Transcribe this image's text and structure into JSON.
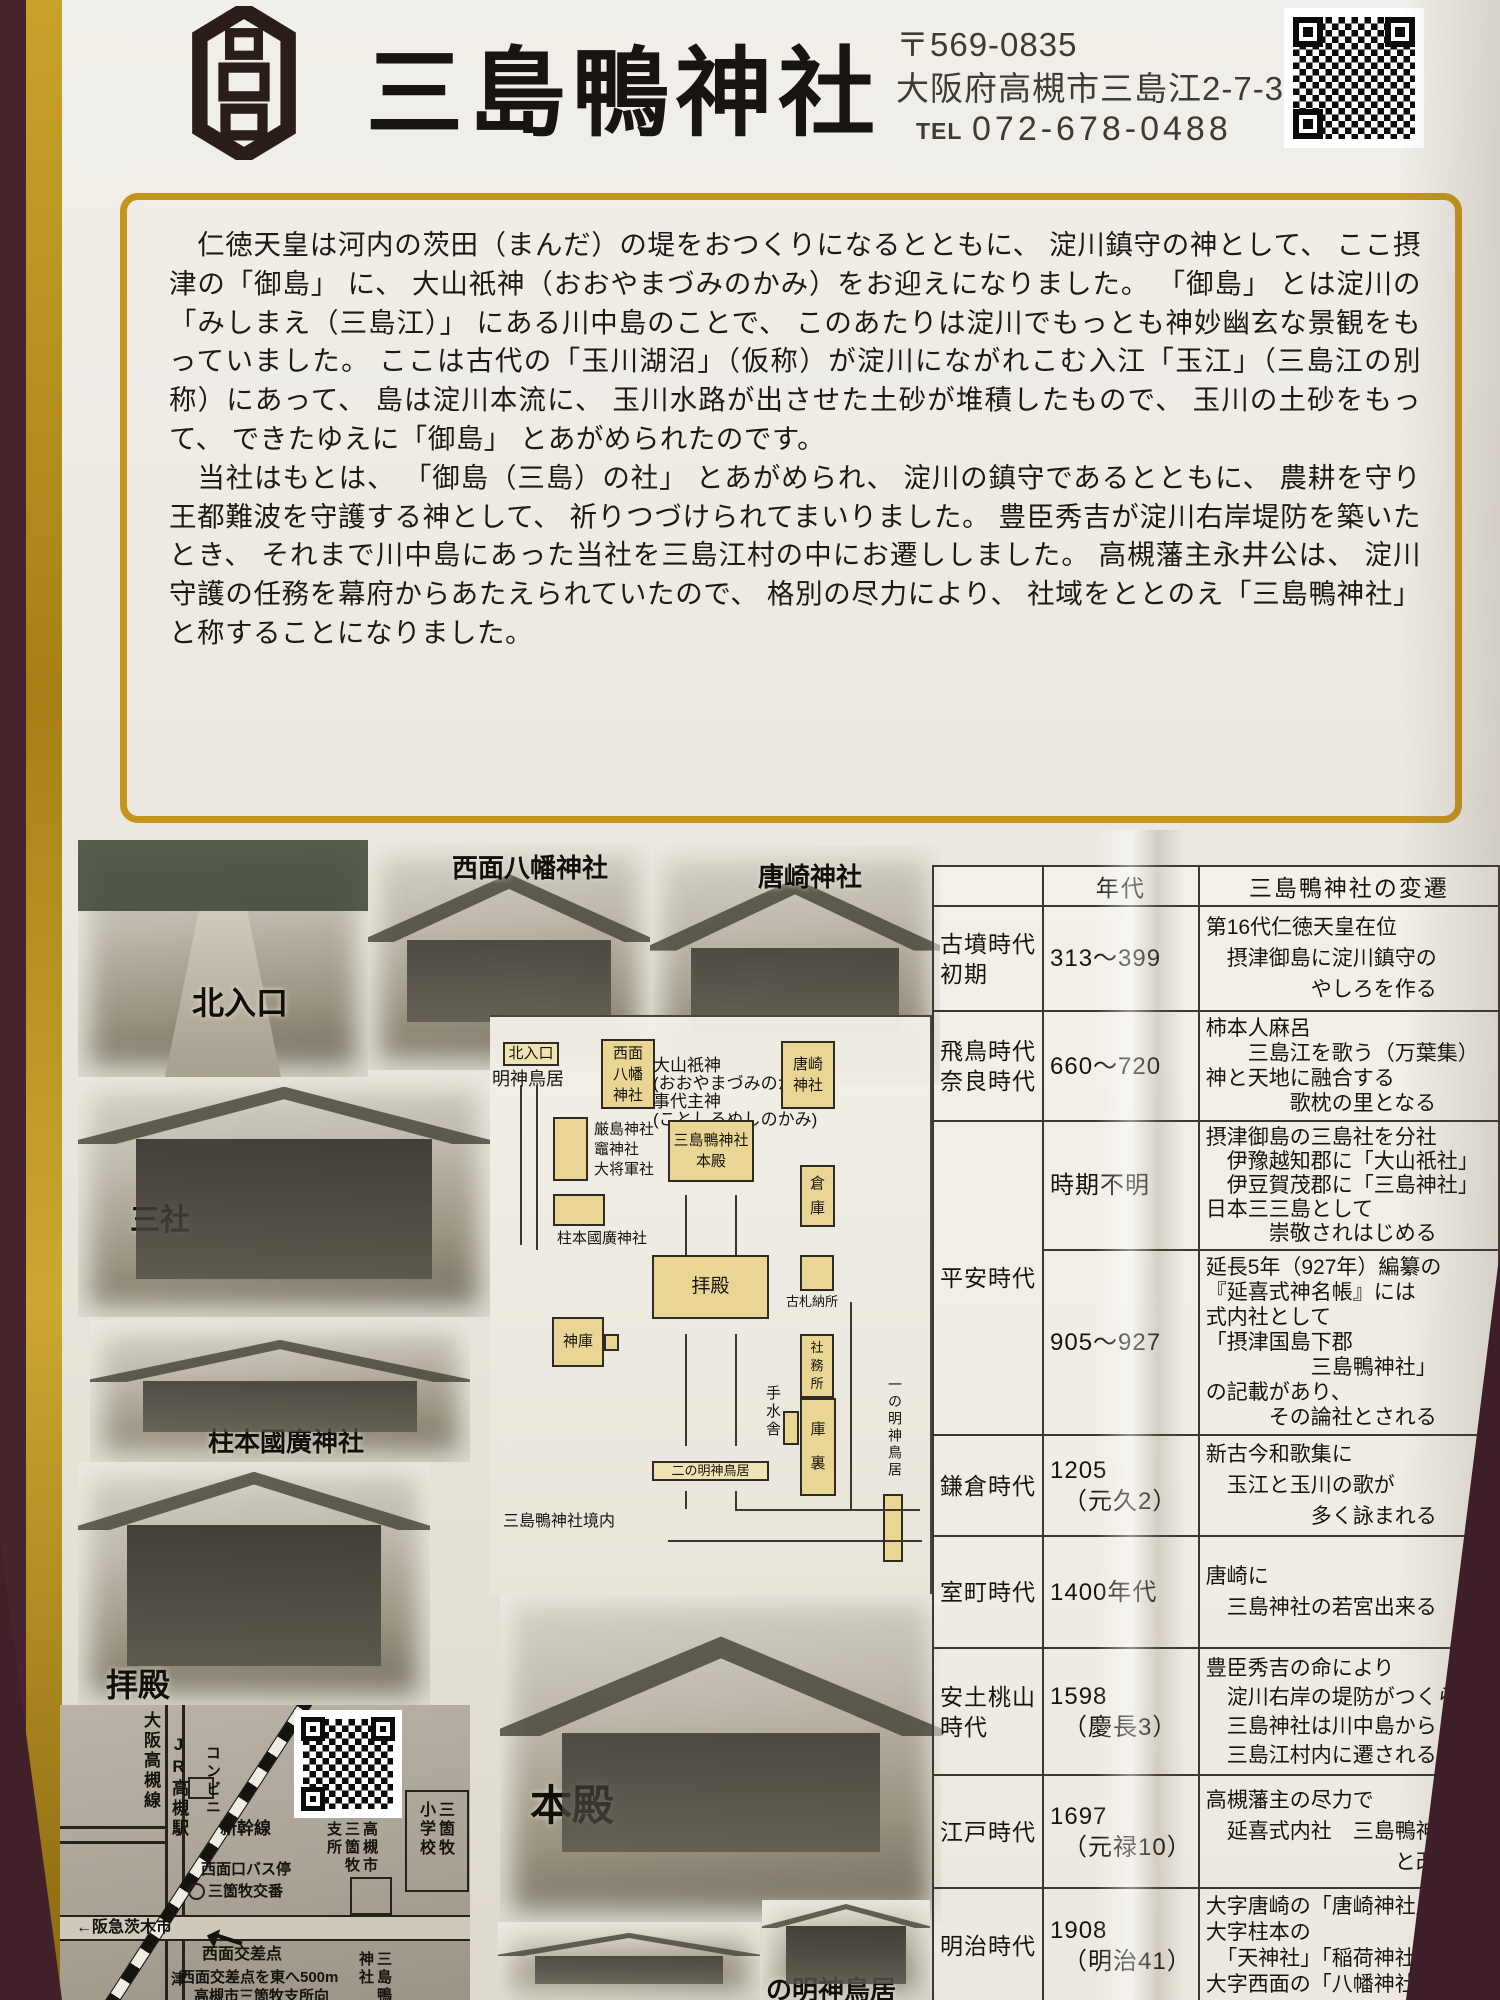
{
  "header": {
    "title": "三島鴨神社",
    "postal": "〒569-0835",
    "address": "大阪府高槻市三島江2-7-37",
    "tel_label": "TEL",
    "tel": "072-678-0488",
    "crest_name": "shrine-crest",
    "accent_gold": "#c3951c",
    "paper_color": "#ece9e2",
    "background_color": "#47242c"
  },
  "intro": {
    "paragraph1": "　仁徳天皇は河内の茨田（まんだ）の堤をおつくりになるとともに、 淀川鎮守の神として、 ここ摂津の「御島」 に、 大山祇神（おおやまづみのかみ）をお迎えになりました。 「御島」 とは淀川の「みしまえ（三島江）」 にある川中島のことで、 このあたりは淀川でもっとも神妙幽玄な景観をもっていました。 ここは古代の「玉川湖沼」（仮称）が淀川にながれこむ入江「玉江」（三島江の別称）にあって、 島は淀川本流に、 玉川水路が出させた土砂が堆積したもので、 玉川の土砂をもって、 できたゆえに「御島」 とあがめられたのです。",
    "paragraph2": "　当社はもとは、 「御島（三島）の社」 とあがめられ、 淀川の鎮守であるとともに、 農耕を守り王都難波を守護する神として、 祈りつづけられてまいりました。 豊臣秀吉が淀川右岸堤防を築いたとき、 それまで川中島にあった当社を三島江村の中にお遷ししました。 高槻藩主永井公は、 淀川守護の任務を幕府からあたえられていたので、 格別の尽力により、 社域をととのえ「三島鴨神社」 と称することになりました。"
  },
  "photos": [
    {
      "id": "kita",
      "caption": "北入口"
    },
    {
      "id": "seimen",
      "caption": "西面八幡神社"
    },
    {
      "id": "karasaki",
      "caption": "唐崎神社"
    },
    {
      "id": "sansha",
      "caption": "三社"
    },
    {
      "id": "hashiramoto",
      "caption": "柱本國廣神社"
    },
    {
      "id": "haiden",
      "caption": "拝殿"
    },
    {
      "id": "honden",
      "caption": "本殿"
    },
    {
      "id": "small-left",
      "caption": ""
    },
    {
      "id": "small-right",
      "caption": "の明神鳥居"
    }
  ],
  "diagram": {
    "items": [
      {
        "id": "kita-iriguchi-tag",
        "kind": "tag",
        "text": "北入口"
      },
      {
        "id": "myojin-torii-label",
        "kind": "label",
        "text": "明神鳥居"
      },
      {
        "id": "seimen-hachiman-box",
        "kind": "box",
        "text": "西面\n八幡\n神社"
      },
      {
        "id": "deities-label",
        "kind": "label",
        "text": "大山祇神\n(おおやまづみのかみ)\n事代主神\n(ことしろぬしのかみ)"
      },
      {
        "id": "karasaki-box",
        "kind": "box",
        "text": "唐崎\n神社"
      },
      {
        "id": "sansha-box",
        "kind": "box",
        "text": ""
      },
      {
        "id": "sansha-label",
        "kind": "label",
        "text": "厳島神社\n竈神社\n大将軍社"
      },
      {
        "id": "honden-box",
        "kind": "box",
        "text": "三島鴨神社\n本殿"
      },
      {
        "id": "soko-box",
        "kind": "box",
        "text": "倉\n庫"
      },
      {
        "id": "hashiramoto-box",
        "kind": "box",
        "text": ""
      },
      {
        "id": "hashiramoto-label",
        "kind": "label",
        "text": "柱本國廣神社"
      },
      {
        "id": "haiden-box",
        "kind": "box",
        "text": "拝殿"
      },
      {
        "id": "kosatsu-box",
        "kind": "box",
        "text": ""
      },
      {
        "id": "kosatsu-label",
        "kind": "label",
        "text": "古札納所"
      },
      {
        "id": "shinko-box",
        "kind": "box",
        "text": "神庫"
      },
      {
        "id": "shinko-tab",
        "kind": "box",
        "text": ""
      },
      {
        "id": "temizusha-label",
        "kind": "vlabel",
        "text": "手水舎"
      },
      {
        "id": "temizusha-box",
        "kind": "box",
        "text": ""
      },
      {
        "id": "shamusho-box",
        "kind": "box",
        "text": "社\n務\n所"
      },
      {
        "id": "kuri-box",
        "kind": "box",
        "text": "庫\n裏"
      },
      {
        "id": "ni-no-torii-tag",
        "kind": "tag",
        "text": "二の明神鳥居"
      },
      {
        "id": "ichi-no-torii-label",
        "kind": "vlabel",
        "text": "一の明神鳥居"
      },
      {
        "id": "ichi-no-torii-box",
        "kind": "box",
        "text": ""
      },
      {
        "id": "keidai-label",
        "kind": "label",
        "text": "三島鴨神社境内"
      }
    ]
  },
  "timeline": {
    "col_headers": [
      "",
      "年代",
      "三島鴨神社の変遷"
    ],
    "rows": [
      {
        "era": "古墳時代\n初期",
        "period": "313～399",
        "events": "第16代仁徳天皇在位\n　摂津御島に淀川鎮守の\n　　　　　やしろを作る"
      },
      {
        "era": "飛鳥時代\n奈良時代",
        "period": "660～720",
        "events": "柿本人麻呂\n　　三島江を歌う（万葉集）\n神と天地に融合する\n　　　　歌枕の里となる"
      },
      {
        "era": "平安時代",
        "era_rowspan": 2,
        "period": "時期不明",
        "events": "摂津御島の三島社を分社\n　伊豫越知郡に「大山祇社」\n　伊豆賀茂郡に「三島神社」\n日本三三島として\n　　　崇敬されはじめる"
      },
      {
        "era": null,
        "period": "905～927",
        "events": "延長5年（927年）編纂の\n『延喜式神名帳』には\n式内社として\n「摂津国島下郡\n　　　　　三島鴨神社」\nの記載があり、\n　　　その論社とされる"
      },
      {
        "era": "鎌倉時代",
        "period": "1205\n　（元久2）",
        "events": "新古今和歌集に\n　玉江と玉川の歌が\n　　　　　多く詠まれる"
      },
      {
        "era": "室町時代",
        "period": "1400年代",
        "events": "唐崎に\n　三島神社の若宮出来る"
      },
      {
        "era": "安土桃山\n時代",
        "period": "1598\n　（慶長3）",
        "events": "豊臣秀吉の命により\n　淀川右岸の堤防がつくられ\n　三島神社は川中島から\n　三島江村内に遷される"
      },
      {
        "era": "江戸時代",
        "period": "1697\n　（元禄10）",
        "events": "高槻藩主の尽力で\n　延喜式内社　三島鴨神社\n　　　　　　　　　と改称"
      },
      {
        "era": "明治時代",
        "period": "1908\n　（明治41）",
        "events": "大字唐崎の「唐崎神社」\n大字柱本の\n　「天神社」「稲荷神社」\n大字西面の「八幡神社」"
      }
    ]
  },
  "map": {
    "labels": [
      {
        "id": "osaka-takatsuki-line",
        "text": "大阪高槻線",
        "v": true
      },
      {
        "id": "jr-takatsuki-station",
        "text": "JR高槻駅",
        "v": true
      },
      {
        "id": "convenience-store",
        "text": "コンビニ",
        "v": true
      },
      {
        "id": "shinkansen",
        "text": "新幹線"
      },
      {
        "id": "seimen-bus-stop",
        "text": "西面口バス停"
      },
      {
        "id": "sankamaki-police-box",
        "text": "三箇牧交番"
      },
      {
        "id": "city-branch-office",
        "text": "高槻市\n三箇牧\n支所",
        "v": true
      },
      {
        "id": "sankamaki-elementary",
        "text": "三箇牧\n小学校",
        "v": true
      },
      {
        "id": "hankyu-ibaraki",
        "text": "←阪急茨木市"
      },
      {
        "id": "seimen-crossing",
        "text": "西面交差点"
      },
      {
        "id": "direction-1",
        "text": "西面交差点を東へ500m"
      },
      {
        "id": "direction-2",
        "text": "高槻市三箇牧支所向"
      },
      {
        "id": "mishima-kamo-jinja",
        "text": "三島鴨\n神社",
        "v": true
      },
      {
        "id": "tsu-road",
        "text": "津",
        "v": true
      }
    ]
  }
}
